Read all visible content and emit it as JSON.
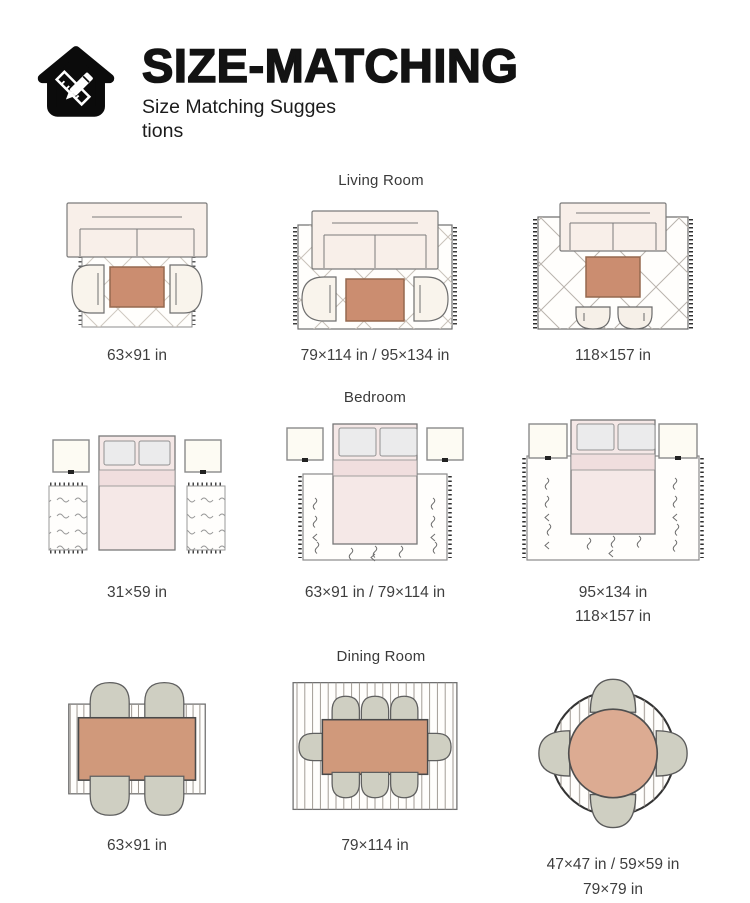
{
  "header": {
    "title": "SIZE-MATCHING",
    "subtitle_line1": "Size Matching Sugges",
    "subtitle_line2": "tions",
    "logo_icon": "house-pencil-ruler-icon"
  },
  "sections": [
    {
      "label": "Living Room",
      "items": [
        {
          "name": "living-room-small",
          "caption1": "63×91 in",
          "caption2": ""
        },
        {
          "name": "living-room-medium",
          "caption1": "79×114 in / 95×134 in",
          "caption2": ""
        },
        {
          "name": "living-room-large",
          "caption1": "118×157 in",
          "caption2": ""
        }
      ]
    },
    {
      "label": "Bedroom",
      "items": [
        {
          "name": "bedroom-runners",
          "caption1": "31×59 in",
          "caption2": ""
        },
        {
          "name": "bedroom-medium",
          "caption1": "63×91 in / 79×114 in",
          "caption2": ""
        },
        {
          "name": "bedroom-large",
          "caption1": "95×134 in",
          "caption2": "118×157 in"
        }
      ]
    },
    {
      "label": "Dining Room",
      "items": [
        {
          "name": "dining-4-seats",
          "caption1": "63×91 in",
          "caption2": ""
        },
        {
          "name": "dining-8-seats",
          "caption1": "79×114 in",
          "caption2": ""
        },
        {
          "name": "dining-round",
          "caption1": "47×47 in / 59×59 in",
          "caption2": "79×79 in"
        }
      ]
    }
  ],
  "colors": {
    "ink": "#131313",
    "terracotta_table": "#cb8d70",
    "dining_table": "#d0997b",
    "round_table": "#dcab92",
    "chair_sage": "#cfcfc2",
    "sofa_cream": "#f8efe9",
    "bed_pink": "#f5e8e7",
    "nightstand_cream": "#fdfbf3"
  }
}
